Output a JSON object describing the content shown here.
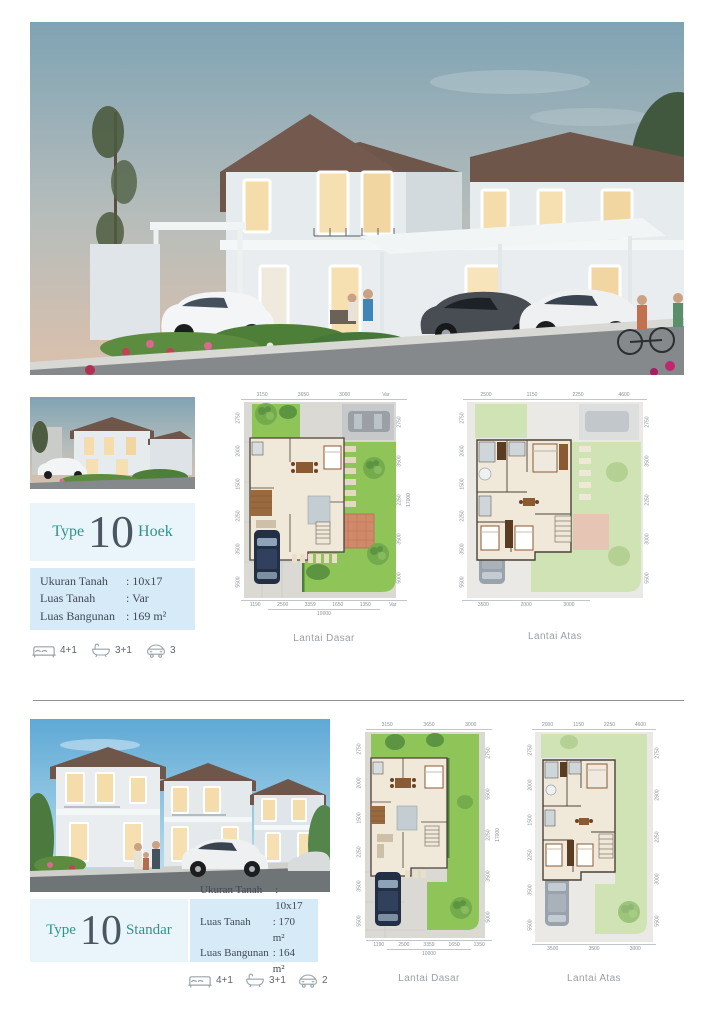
{
  "colors": {
    "accent_teal": "#2e948b",
    "number_dark": "#4a5660",
    "box_light": "#e9f4fb",
    "box_mid": "#d6eaf7",
    "label_gray": "#9aa0a6"
  },
  "sections": [
    {
      "title": {
        "prefix": "Type",
        "number": "10",
        "suffix": "Hoek"
      },
      "specs": [
        {
          "label": "Ukuran Tanah",
          "value": ": 10x17"
        },
        {
          "label": "Luas Tanah",
          "value": ": Var"
        },
        {
          "label": "Luas Bangunan",
          "value": ": 169 m²"
        }
      ],
      "amenities": [
        {
          "icon": "bed-icon",
          "count": "4+1"
        },
        {
          "icon": "bath-icon",
          "count": "3+1"
        },
        {
          "icon": "car-icon",
          "count": "3"
        }
      ],
      "plans": [
        {
          "label": "Lantai Dasar",
          "dims_top": [
            "3150",
            "3650",
            "3000",
            "Var"
          ],
          "dims_left": [
            "2750",
            "2000",
            "1500",
            "2250",
            "3500",
            "5500"
          ],
          "dims_right": [
            "2750",
            "3500",
            "2250",
            "3500",
            "5000"
          ],
          "right_total": "17000",
          "dims_bottom": [
            "1190",
            "2500",
            "3359",
            "1650",
            "1350",
            "Var"
          ],
          "bottom_total": "10000"
        },
        {
          "label": "Lantai Atas",
          "dims_top": [
            "2500",
            "1150",
            "2250",
            "4600"
          ],
          "dims_left": [
            "2750",
            "2000",
            "1500",
            "2250",
            "3500",
            "5500"
          ],
          "dims_right": [
            "2750",
            "3500",
            "2250",
            "3000",
            "5500"
          ],
          "dims_bottom": [
            "3500",
            "2000",
            "3000"
          ]
        }
      ]
    },
    {
      "title": {
        "prefix": "Type",
        "number": "10",
        "suffix": "Standar"
      },
      "specs": [
        {
          "label": "Ukuran Tanah",
          "value": ": 10x17"
        },
        {
          "label": "Luas Tanah",
          "value": ": 170 m²"
        },
        {
          "label": "Luas Bangunan",
          "value": ": 164 m²"
        }
      ],
      "amenities": [
        {
          "icon": "bed-icon",
          "count": "4+1"
        },
        {
          "icon": "bath-icon",
          "count": "3+1"
        },
        {
          "icon": "car-icon",
          "count": "2"
        }
      ],
      "plans": [
        {
          "label": "Lantai Dasar",
          "dims_top": [
            "3150",
            "3650",
            "3000"
          ],
          "dims_left": [
            "2750",
            "2000",
            "1500",
            "2250",
            "3500",
            "5500"
          ],
          "dims_right": [
            "2750",
            "5500",
            "2250",
            "3500",
            "5000"
          ],
          "right_total": "17000",
          "dims_bottom": [
            "1190",
            "2500",
            "3359",
            "1650",
            "1350"
          ],
          "bottom_total": "10000"
        },
        {
          "label": "Lantai Atas",
          "dims_top": [
            "2000",
            "1150",
            "2250",
            "4600"
          ],
          "dims_left": [
            "2750",
            "2000",
            "1500",
            "2250",
            "3500",
            "5500"
          ],
          "dims_right": [
            "2750",
            "2900",
            "2250",
            "3000",
            "5500"
          ],
          "dims_bottom": [
            "3500",
            "3500",
            "3000"
          ]
        }
      ]
    }
  ]
}
